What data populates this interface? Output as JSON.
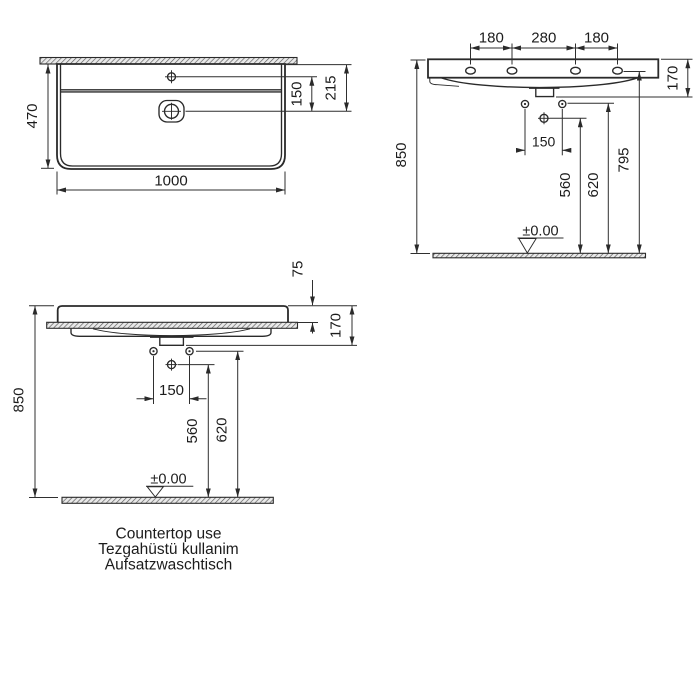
{
  "drawing": {
    "caption": {
      "en": "Countertop use",
      "tr": "Tezgahüstü kullanim",
      "de": "Aufsatzwaschtisch"
    },
    "plan_view": {
      "overall_width": "1000",
      "overall_depth": "470",
      "tap_hole_to_drain": "150",
      "back_edge_to_drain": "215"
    },
    "wall_elevation": {
      "tap_hole_spacing": [
        "180",
        "280",
        "180"
      ],
      "basin_height": "170",
      "rim_height_from_floor": "850",
      "tap_hole_height": "795",
      "fixing_hole_height": "620",
      "drain_height": "560",
      "fixing_hole_spacing": "150",
      "floor_datum": "±0.00"
    },
    "countertop_elevation": {
      "rim_above_countertop": "75",
      "basin_height": "170",
      "rim_height_from_floor": "850",
      "fixing_hole_height": "620",
      "drain_height": "560",
      "fixing_hole_spacing": "150",
      "floor_datum": "±0.00"
    }
  },
  "colors": {
    "line": "#2a2a2a",
    "dimension_text": "#1c1c1c",
    "hatch": "#5a5a5a",
    "background": "#ffffff"
  }
}
